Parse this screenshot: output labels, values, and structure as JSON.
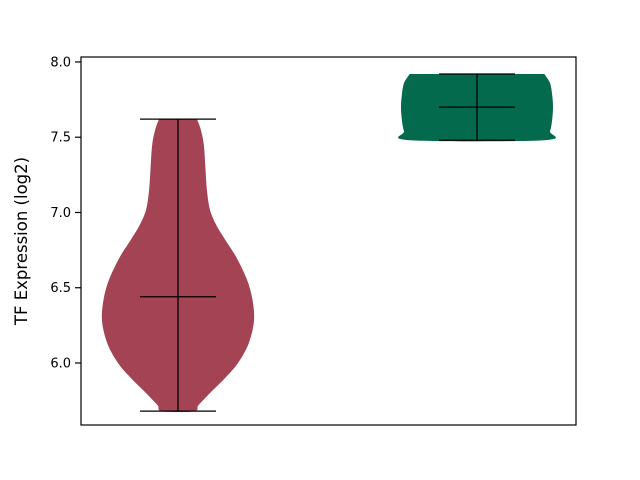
{
  "figure": {
    "background": "#ffffff"
  },
  "chart_data": {
    "type": "violin",
    "title": "",
    "xlabel": "",
    "ylabel": "TF Expression (log2)",
    "y_ticks": [
      8.0,
      7.5,
      7.0,
      6.5,
      6.0
    ],
    "y_tick_labels": [
      "8.0",
      "7.5",
      "7.0",
      "6.5",
      "6.0"
    ],
    "ylim": [
      5.588,
      8.033
    ],
    "x_tick_labels": [],
    "grid": false,
    "legend": "none",
    "inner_line_color": "#000000",
    "spine_color": "#000000",
    "series": [
      {
        "name": "violin-left",
        "color": "#a34353",
        "position": 0,
        "min": 5.68,
        "max": 7.62,
        "median": 6.44,
        "profile": [
          [
            7.62,
            0.25
          ],
          [
            7.55,
            0.3
          ],
          [
            7.45,
            0.34
          ],
          [
            7.3,
            0.36
          ],
          [
            7.15,
            0.38
          ],
          [
            7.02,
            0.42
          ],
          [
            6.92,
            0.5
          ],
          [
            6.82,
            0.62
          ],
          [
            6.7,
            0.77
          ],
          [
            6.55,
            0.91
          ],
          [
            6.42,
            0.98
          ],
          [
            6.28,
            1.0
          ],
          [
            6.13,
            0.93
          ],
          [
            6.0,
            0.79
          ],
          [
            5.9,
            0.62
          ],
          [
            5.8,
            0.42
          ],
          [
            5.72,
            0.27
          ],
          [
            5.68,
            0.21
          ]
        ]
      },
      {
        "name": "violin-right",
        "color": "#046a4e",
        "position": 1,
        "min": 7.48,
        "max": 7.92,
        "median": 7.7,
        "profile": [
          [
            7.92,
            0.885
          ],
          [
            7.86,
            0.96
          ],
          [
            7.78,
            0.99
          ],
          [
            7.7,
            1.0
          ],
          [
            7.62,
            0.99
          ],
          [
            7.54,
            0.96
          ],
          [
            7.48,
            0.885
          ]
        ]
      }
    ]
  }
}
